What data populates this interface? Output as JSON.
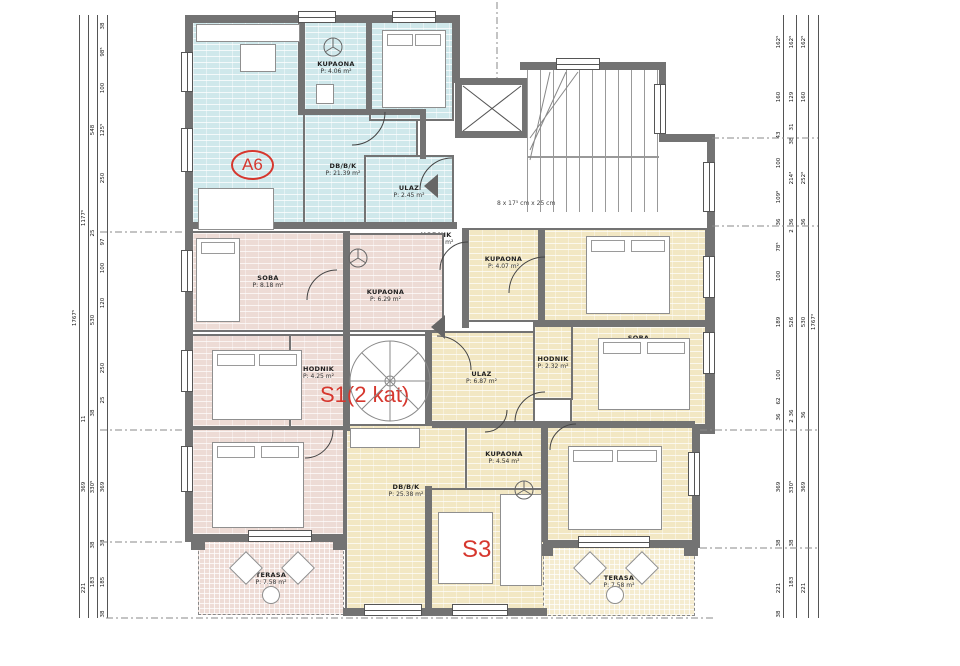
{
  "drawing": {
    "apartment_labels": {
      "a6": "A6",
      "s1": "S1(2 kat)",
      "s3": "S3"
    },
    "stair_note": "8 x 17⁵ cm x 25 cm",
    "rooms": [
      {
        "name": "KUPAONA",
        "area": "P: 4.06 m²"
      },
      {
        "name": "SOBA",
        "area": "P: 10.58 m²"
      },
      {
        "name": "DB/B/K",
        "area": "P: 21.39 m²"
      },
      {
        "name": "ULAZ",
        "area": "P: 2.45 m²"
      },
      {
        "name": "HODNIK",
        "area": "P: 17.90 m²"
      },
      {
        "name": "SOBA",
        "area": "P: 8.18 m²"
      },
      {
        "name": "KUPAONA",
        "area": "P: 6.29 m²"
      },
      {
        "name": "SOBA",
        "area": "P: 10.62 m²"
      },
      {
        "name": "HODNIK",
        "area": "P: 4.25 m²"
      },
      {
        "name": "SOBA",
        "area": "P: 11.89 m²"
      },
      {
        "name": "TERASA",
        "area": "P: 7.58 m²"
      },
      {
        "name": "KUPAONA",
        "area": "P: 4.07 m²"
      },
      {
        "name": "SOBA",
        "area": "P: 12.44 m²"
      },
      {
        "name": "SOBA",
        "area": "P: 9.66 m²"
      },
      {
        "name": "HODNIK",
        "area": "P: 2.32 m²"
      },
      {
        "name": "ULAZ",
        "area": "P: 6.87 m²"
      },
      {
        "name": "KUPAONA",
        "area": "P: 4.54 m²"
      },
      {
        "name": "DB/B/K",
        "area": "P: 25.38 m²"
      },
      {
        "name": "SOBA",
        "area": "P: 12.05 m²"
      },
      {
        "name": "TERASA",
        "area": "P: 7.58 m²"
      }
    ],
    "dimensions": {
      "left": {
        "total": [
          "1767⁵"
        ],
        "major": [
          "1177⁶",
          "11",
          "369",
          "221"
        ],
        "mid": [
          "548",
          "25",
          "530",
          "38",
          "330⁵",
          "38",
          "183"
        ],
        "minor": [
          "38",
          "98⁵",
          "100",
          "125⁵",
          "250",
          "97",
          "100",
          "120",
          "250",
          "25",
          "369",
          "38",
          "185",
          "38"
        ]
      },
      "right": {
        "minor": [
          "162⁵",
          "160",
          "43",
          "100",
          "109⁶",
          "36",
          "78⁵",
          "100",
          "189",
          "100",
          "62",
          "36",
          "369",
          "38",
          "221",
          "38"
        ],
        "mid": [
          "162⁵",
          "129",
          "31",
          "38",
          "214³",
          "36",
          "2",
          "526",
          "36",
          "2",
          "330⁵",
          "38",
          "183"
        ],
        "major": [
          "162⁵",
          "160",
          "252⁶",
          "36",
          "530",
          "36",
          "369",
          "221"
        ],
        "total": [
          "1767³"
        ]
      }
    },
    "colors": {
      "wall": "#737373",
      "apartment_a6": "#cfe8eb",
      "apartment_s1": "#eddbd5",
      "apartment_s3": "#f2e7c3",
      "terrace_s1": "#eedcd6",
      "terrace_s3": "#f5ecd0",
      "unit_label_red": "#d6372e"
    }
  }
}
